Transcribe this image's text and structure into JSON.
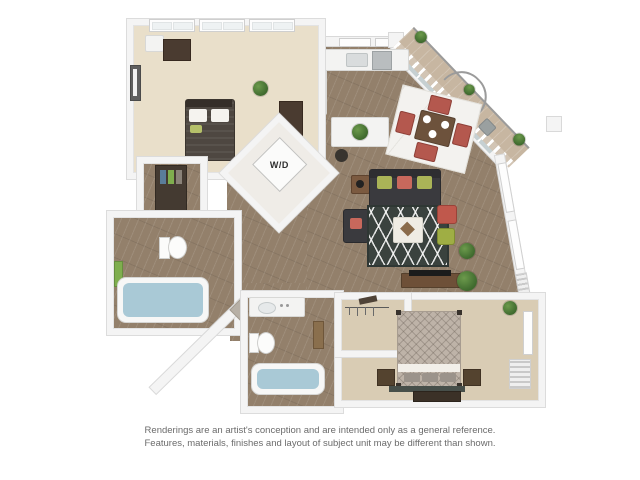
{
  "floorplan": {
    "wd_label": "W/D"
  },
  "disclaimer": {
    "line1": "Renderings are an artist's conception and are intended only as a general reference.",
    "line2": "Features, materials, finishes and layout of subject unit may be different than shown."
  },
  "palette": {
    "background": "#ffffff",
    "wall": "#f4f4f4",
    "wall_edge": "#d9d9d9",
    "wood_floor": "#93806b",
    "balcony_floor": "#c7b6a1",
    "bedroom1_carpet": "#e9dfca",
    "bedroom2_carpet": "#d9ccb4",
    "sofa_charcoal": "#37373a",
    "accent_red": "#c0584c",
    "accent_green": "#9fae44",
    "plant_green": "#4c7c3e",
    "rug_dark": "#3a423e",
    "tub_water": "#a9c9d6",
    "bed1_bedding": "#4e4741",
    "bed2_bedding": "#beb3a8",
    "disclaimer_text": "#6b6b6b"
  }
}
